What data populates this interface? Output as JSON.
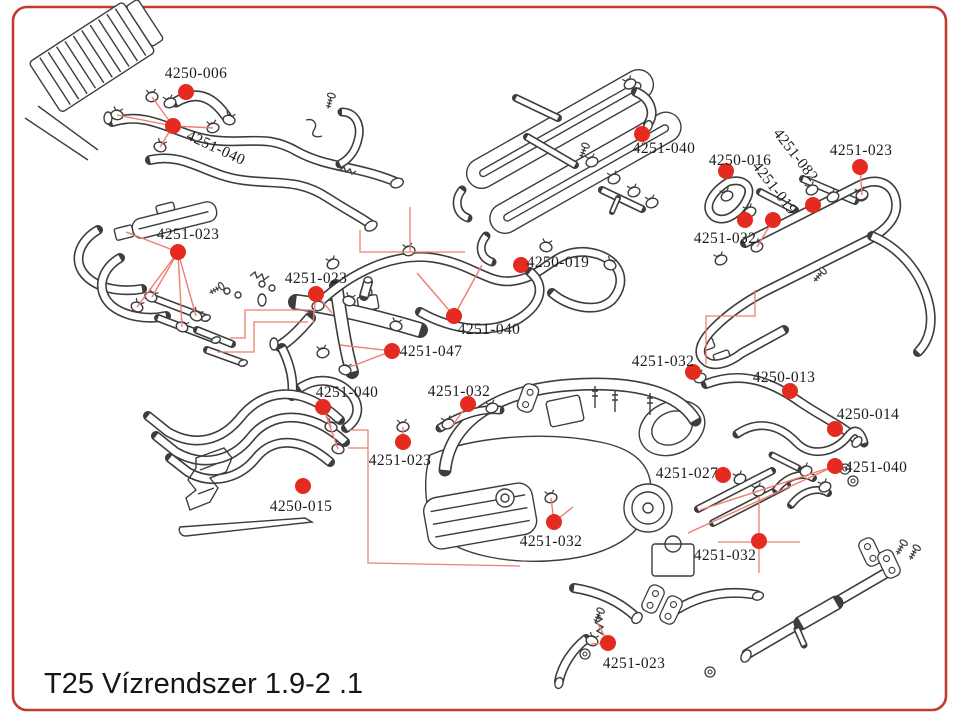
{
  "page": {
    "title": "T25 Vízrendszer 1.9-2 .1"
  },
  "colors": {
    "border": "#c43b2e",
    "dot": "#e52b20",
    "leader": "#ee7e72",
    "line_art": "#3d3d3d",
    "label_text": "#1c1c1c"
  },
  "diagram": {
    "type": "parts-callout-diagram",
    "callouts": [
      {
        "part_no": "4250-006",
        "label": {
          "x": 196,
          "y": 78,
          "rotation": 0
        },
        "dot": {
          "x": 186,
          "y": 92
        },
        "leaders": []
      },
      {
        "part_no": "4251-040",
        "label": {
          "x": 214,
          "y": 152,
          "rotation": 25
        },
        "dot": {
          "x": 173,
          "y": 126
        },
        "leaders": [
          [
            152,
            97
          ],
          [
            117,
            115
          ],
          [
            160,
            147
          ],
          [
            213,
            128
          ]
        ]
      },
      {
        "part_no": "4251-023",
        "label": {
          "x": 188,
          "y": 239,
          "rotation": 0
        },
        "dot": {
          "x": 178,
          "y": 252
        },
        "leaders": [
          [
            126,
            232
          ],
          [
            137,
            307
          ],
          [
            152,
            297
          ],
          [
            182,
            327
          ],
          [
            196,
            316
          ]
        ]
      },
      {
        "part_no": "4251-023",
        "label": {
          "x": 316,
          "y": 283,
          "rotation": 0
        },
        "dot": {
          "x": 316,
          "y": 294
        },
        "leaders": [
          [
            332,
            313
          ],
          [
            313,
            323
          ]
        ]
      },
      {
        "part_no": "4250-019",
        "label": {
          "x": 558,
          "y": 267,
          "rotation": 0
        },
        "dot": {
          "x": 521,
          "y": 265
        },
        "leaders": []
      },
      {
        "part_no": "4251-040",
        "label": {
          "x": 489,
          "y": 334,
          "rotation": 0
        },
        "dot": {
          "x": 454,
          "y": 316
        },
        "leaders": [
          [
            417,
            273
          ],
          [
            482,
            265
          ]
        ]
      },
      {
        "part_no": "4251-047",
        "label": {
          "x": 431,
          "y": 356,
          "rotation": 0
        },
        "dot": {
          "x": 392,
          "y": 351
        },
        "leaders": [
          [
            340,
            345
          ],
          [
            350,
            367
          ]
        ]
      },
      {
        "part_no": "4251-040",
        "label": {
          "x": 347,
          "y": 397,
          "rotation": 0
        },
        "dot": {
          "x": 323,
          "y": 407
        },
        "leaders": [
          [
            331,
            427
          ],
          [
            338,
            449
          ]
        ]
      },
      {
        "part_no": "4251-032",
        "label": {
          "x": 459,
          "y": 396,
          "rotation": 0
        },
        "dot": {
          "x": 468,
          "y": 404
        },
        "leaders": [
          [
            452,
            426
          ]
        ]
      },
      {
        "part_no": "4251-023",
        "label": {
          "x": 400,
          "y": 465,
          "rotation": 0
        },
        "dot": {
          "x": 403,
          "y": 442
        },
        "leaders": [
          [
            403,
            427
          ]
        ]
      },
      {
        "part_no": "4250-015",
        "label": {
          "x": 301,
          "y": 511,
          "rotation": 0
        },
        "dot": {
          "x": 303,
          "y": 486
        },
        "leaders": []
      },
      {
        "part_no": "4251-040",
        "label": {
          "x": 664,
          "y": 153,
          "rotation": 0
        },
        "dot": {
          "x": 642,
          "y": 134
        },
        "leaders": []
      },
      {
        "part_no": "4250-016",
        "label": {
          "x": 740,
          "y": 165,
          "rotation": 0
        },
        "dot": {
          "x": 726,
          "y": 171
        },
        "leaders": []
      },
      {
        "part_no": "4251-019",
        "label": {
          "x": 771,
          "y": 191,
          "rotation": 52
        },
        "dot": {
          "x": 773,
          "y": 220
        },
        "leaders": [
          [
            757,
            247
          ]
        ]
      },
      {
        "part_no": "4251-082",
        "label": {
          "x": 792,
          "y": 158,
          "rotation": 52
        },
        "dot": {
          "x": 813,
          "y": 205
        },
        "leaders": []
      },
      {
        "part_no": "4251-023",
        "label": {
          "x": 861,
          "y": 155,
          "rotation": 0
        },
        "dot": {
          "x": 860,
          "y": 167
        },
        "leaders": [
          [
            862,
            195
          ]
        ]
      },
      {
        "part_no": "4251-032",
        "label": {
          "x": 725,
          "y": 243,
          "rotation": 0
        },
        "dot": {
          "x": 745,
          "y": 220
        },
        "leaders": []
      },
      {
        "part_no": "4251-032",
        "label": {
          "x": 663,
          "y": 366,
          "rotation": 0
        },
        "dot": {
          "x": 693,
          "y": 372
        },
        "leaders": []
      },
      {
        "part_no": "4250-013",
        "label": {
          "x": 784,
          "y": 382,
          "rotation": 0
        },
        "dot": {
          "x": 790,
          "y": 391
        },
        "leaders": []
      },
      {
        "part_no": "4250-014",
        "label": {
          "x": 868,
          "y": 419,
          "rotation": 0
        },
        "dot": {
          "x": 835,
          "y": 429
        },
        "leaders": []
      },
      {
        "part_no": "4251-040",
        "label": {
          "x": 876,
          "y": 472,
          "rotation": 0
        },
        "dot": {
          "x": 835,
          "y": 466
        },
        "leaders": [
          [
            700,
            510
          ],
          [
            688,
            533
          ]
        ]
      },
      {
        "part_no": "4251-027",
        "label": {
          "x": 687,
          "y": 478,
          "rotation": 0
        },
        "dot": {
          "x": 723,
          "y": 475
        },
        "leaders": []
      },
      {
        "part_no": "4251-032",
        "label": {
          "x": 551,
          "y": 546,
          "rotation": 0
        },
        "dot": {
          "x": 554,
          "y": 522
        },
        "leaders": [
          [
            551,
            498
          ],
          [
            573,
            507
          ]
        ]
      },
      {
        "part_no": "4251-032",
        "label": {
          "x": 725,
          "y": 560,
          "rotation": 0
        },
        "dot": {
          "x": 759,
          "y": 541
        },
        "leaders": []
      },
      {
        "part_no": "4251-023",
        "label": {
          "x": 634,
          "y": 668,
          "rotation": 0
        },
        "dot": {
          "x": 608,
          "y": 643
        },
        "leaders": [
          [
            597,
            622
          ],
          [
            591,
            644
          ]
        ]
      }
    ],
    "routing_lines": [
      [
        [
          313,
          310
        ],
        [
          245,
          310
        ],
        [
          245,
          338
        ],
        [
          230,
          338
        ]
      ],
      [
        [
          308,
          322
        ],
        [
          254,
          322
        ],
        [
          254,
          352
        ],
        [
          217,
          352
        ]
      ],
      [
        [
          360,
          230
        ],
        [
          360,
          252
        ],
        [
          465,
          252
        ]
      ],
      [
        [
          410,
          207
        ],
        [
          410,
          252
        ]
      ],
      [
        [
          350,
          430
        ],
        [
          368,
          430
        ],
        [
          368,
          563
        ],
        [
          520,
          566
        ]
      ],
      [
        [
          348,
          448
        ],
        [
          368,
          448
        ]
      ],
      [
        [
          755,
          290
        ],
        [
          755,
          316
        ],
        [
          706,
          316
        ],
        [
          706,
          364
        ]
      ],
      [
        [
          718,
          542
        ],
        [
          800,
          542
        ]
      ],
      [
        [
          759,
          497
        ],
        [
          759,
          573
        ]
      ]
    ]
  }
}
